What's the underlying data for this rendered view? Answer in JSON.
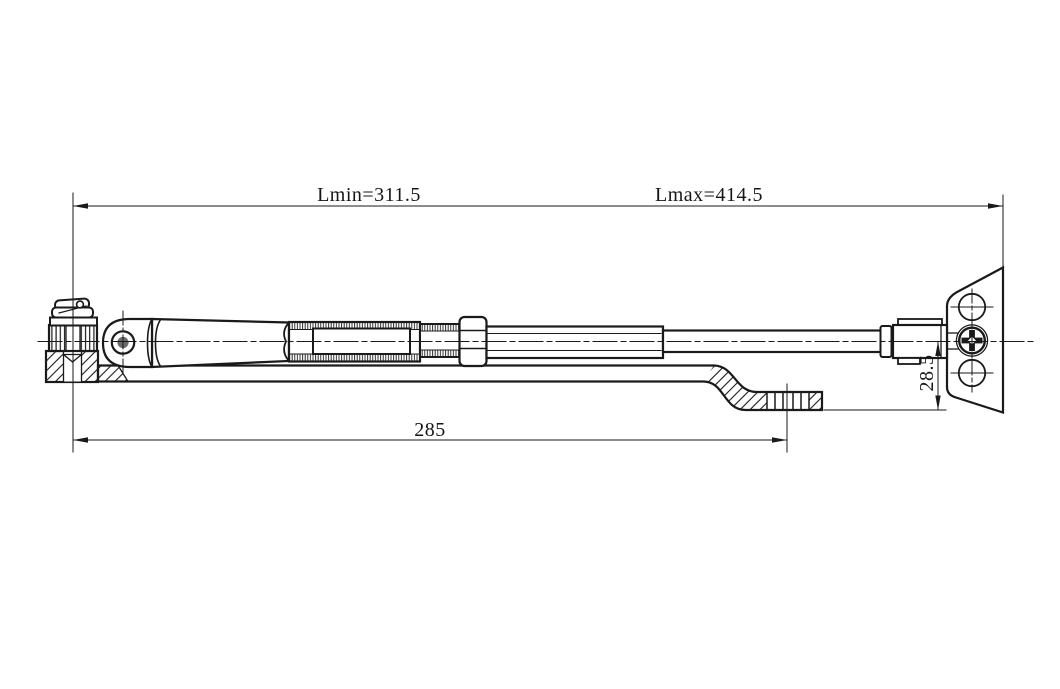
{
  "drawing": {
    "labels": {
      "lmin": "Lmin=311.5",
      "lmax": "Lmax=414.5",
      "arm_span": "285",
      "offset": "28.5"
    },
    "colors": {
      "line": "#1a1a1a",
      "background": "#ffffff",
      "pin_fill": "#6a6a6a"
    }
  }
}
